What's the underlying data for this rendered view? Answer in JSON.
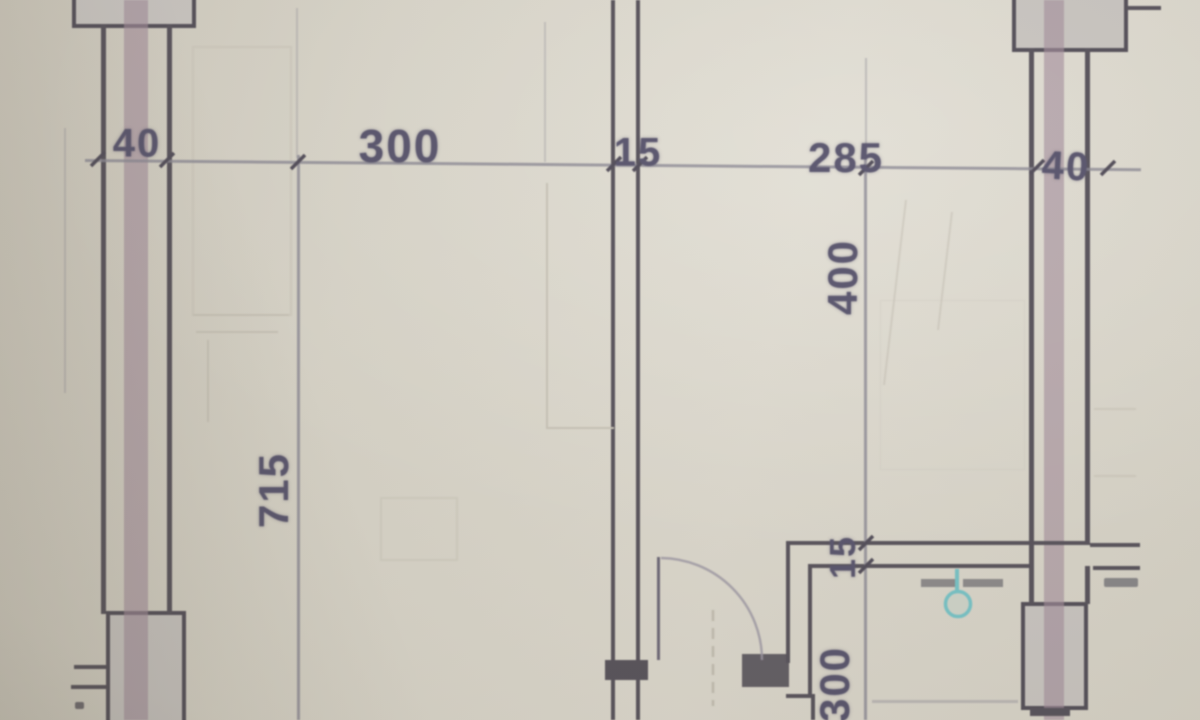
{
  "drawing": {
    "kind": "floor-plan-photo",
    "dimensions": {
      "top_chain": [
        {
          "label": "40"
        },
        {
          "label": "300"
        },
        {
          "label": "15"
        },
        {
          "label": "285"
        },
        {
          "label": "40"
        }
      ],
      "left_vertical": {
        "label": "715"
      },
      "right_vertical_chain": [
        {
          "label": "400"
        },
        {
          "label": "15"
        },
        {
          "label": "300"
        }
      ]
    },
    "symbols": {
      "fixture": {
        "name": "round-fixture",
        "color": "#74c2c6"
      },
      "door": {
        "name": "door-swing"
      }
    },
    "colors": {
      "background": "#d7d3c7",
      "wall_line": "#544f58",
      "wall_core": "#a18a9a",
      "column_fill": "#c8c4c0",
      "dimension_text": "#55516a",
      "fixture_teal": "#74c2c6"
    }
  }
}
